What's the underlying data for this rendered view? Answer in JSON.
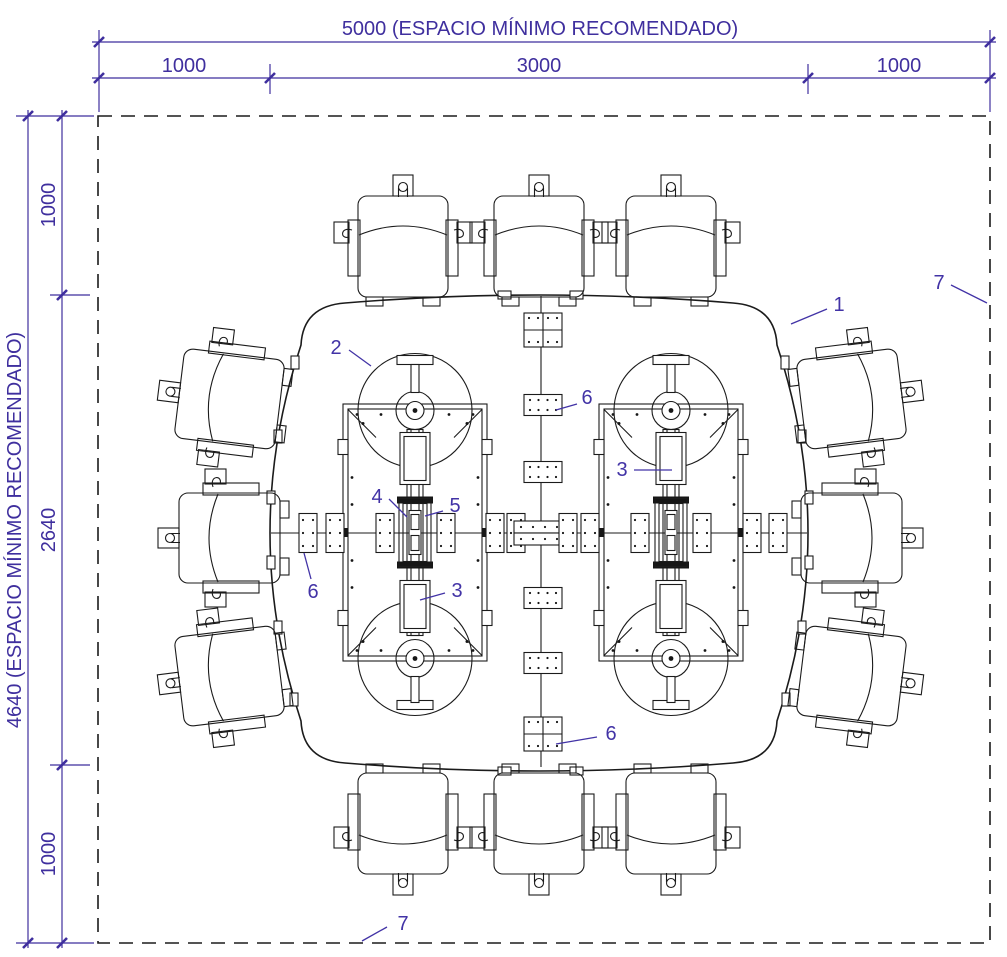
{
  "drawing_title": "Conference table clearance plan",
  "colors": {
    "dimension_purple": "#3f2f9e",
    "callout_purple": "#4233a6",
    "line_black": "#1b1b1b",
    "background": "#ffffff"
  },
  "dimensions": {
    "top": {
      "overall_label": "5000 (ESPACIO MÍNIMO RECOMENDADO)",
      "segments": [
        "1000",
        "3000",
        "1000"
      ]
    },
    "left": {
      "overall_label": "4640 (ESPACIO MÍNIMO RECOMENDADO)",
      "segments": [
        "1000",
        "2640",
        "1000"
      ]
    }
  },
  "callouts": {
    "instances": [
      {
        "label": "1"
      },
      {
        "label": "7"
      },
      {
        "label": "2"
      },
      {
        "label": "6"
      },
      {
        "label": "3"
      },
      {
        "label": "4"
      },
      {
        "label": "5"
      },
      {
        "label": "3"
      },
      {
        "label": "6"
      },
      {
        "label": "6"
      },
      {
        "label": "7"
      }
    ]
  }
}
